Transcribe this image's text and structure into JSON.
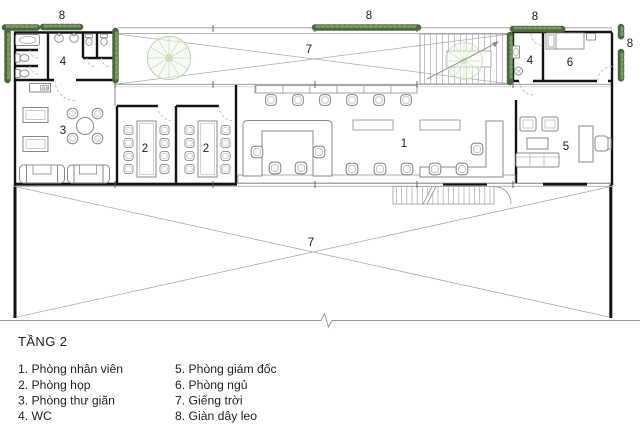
{
  "title": "TẦNG 2",
  "legend": {
    "items": [
      "1. Phòng nhân viên",
      "2. Phòng họp",
      "3. Phòng thư giãn",
      "4. WC",
      "5. Phòng giám đốc",
      "6. Phòng ngủ",
      "7. Giếng trời",
      "8. Giàn dây leo"
    ]
  },
  "plan": {
    "labels": {
      "staff_room": "1",
      "meeting_room": "2",
      "lounge": "3",
      "wc": "4",
      "director_room": "5",
      "bedroom": "6",
      "skylight": "7",
      "trellis": "8"
    },
    "colors": {
      "wall": "#141414",
      "furniture": "#8a8a8a",
      "vine_green": "#4d683c",
      "tree_green": "#b9d5a5"
    }
  }
}
